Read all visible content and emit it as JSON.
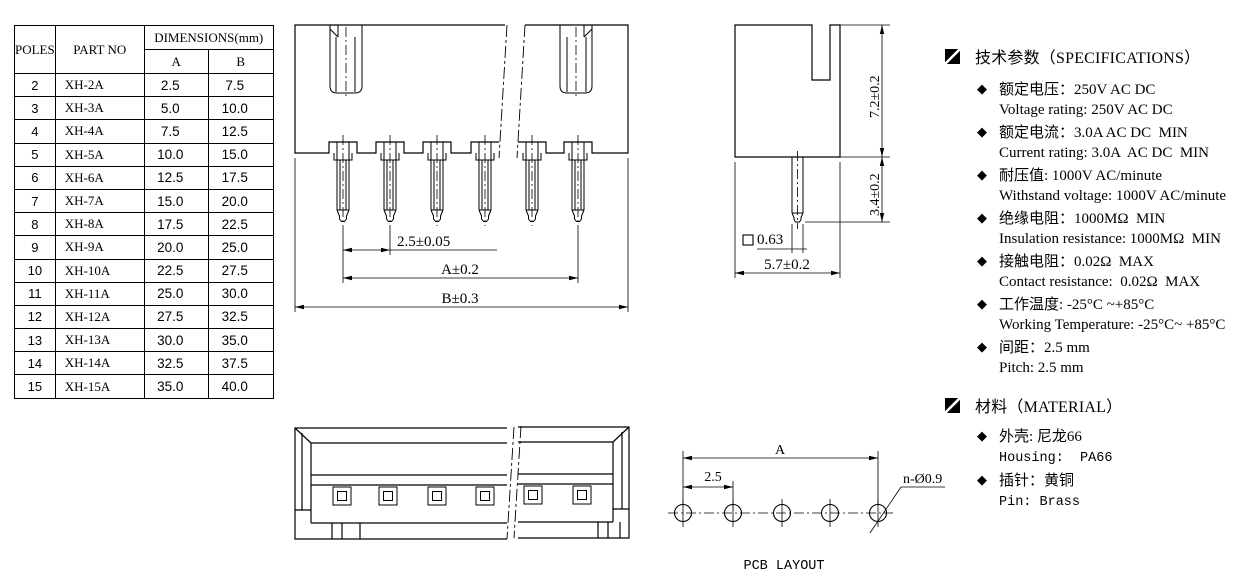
{
  "colors": {
    "line": "#000000",
    "background": "#ffffff"
  },
  "table": {
    "col_poles": "POLES",
    "col_part_no": "PART NO",
    "col_dimensions": "DIMENSIONS(mm)",
    "col_a": "A",
    "col_b": "B",
    "rows": [
      {
        "poles": "2",
        "part": "XH-2A",
        "a": "2.5",
        "b": "7.5"
      },
      {
        "poles": "3",
        "part": "XH-3A",
        "a": "5.0",
        "b": "10.0"
      },
      {
        "poles": "4",
        "part": "XH-4A",
        "a": "7.5",
        "b": "12.5"
      },
      {
        "poles": "5",
        "part": "XH-5A",
        "a": "10.0",
        "b": "15.0"
      },
      {
        "poles": "6",
        "part": "XH-6A",
        "a": "12.5",
        "b": "17.5"
      },
      {
        "poles": "7",
        "part": "XH-7A",
        "a": "15.0",
        "b": "20.0"
      },
      {
        "poles": "8",
        "part": "XH-8A",
        "a": "17.5",
        "b": "22.5"
      },
      {
        "poles": "9",
        "part": "XH-9A",
        "a": "20.0",
        "b": "25.0"
      },
      {
        "poles": "10",
        "part": "XH-10A",
        "a": "22.5",
        "b": "27.5"
      },
      {
        "poles": "11",
        "part": "XH-11A",
        "a": "25.0",
        "b": "30.0"
      },
      {
        "poles": "12",
        "part": "XH-12A",
        "a": "27.5",
        "b": "32.5"
      },
      {
        "poles": "13",
        "part": "XH-13A",
        "a": "30.0",
        "b": "35.0"
      },
      {
        "poles": "14",
        "part": "XH-14A",
        "a": "32.5",
        "b": "37.5"
      },
      {
        "poles": "15",
        "part": "XH-15A",
        "a": "35.0",
        "b": "40.0"
      }
    ]
  },
  "front_view": {
    "dim_pitch": "2.5±0.05",
    "dim_a": "A±0.2",
    "dim_b": "B±0.3"
  },
  "side_view": {
    "dim_height": "7.2±0.2",
    "dim_pin_len": "3.4±0.2",
    "pin_square": "0.63",
    "dim_depth": "5.7±0.2"
  },
  "pcb": {
    "dim_a": "A",
    "dim_pitch": "2.5",
    "hole_label": "n-Ø0.9",
    "caption": "PCB LAYOUT"
  },
  "specs": {
    "title": "技术参数（SPECIFICATIONS）",
    "items": [
      {
        "zh": "额定电压：250V AC DC",
        "en": "Voltage rating: 250V AC DC"
      },
      {
        "zh": "额定电流：3.0A AC DC  MIN",
        "en": "Current rating: 3.0A  AC DC  MIN"
      },
      {
        "zh": "耐压值: 1000V AC/minute",
        "en": "Withstand voltage: 1000V AC/minute"
      },
      {
        "zh": "绝缘电阻：1000MΩ  MIN",
        "en": "Insulation resistance: 1000MΩ  MIN"
      },
      {
        "zh": "接触电阻：0.02Ω  MAX",
        "en": "Contact resistance:  0.02Ω  MAX"
      },
      {
        "zh": "工作温度: -25°C ~+85°C",
        "en": "Working Temperature: -25°C~ +85°C"
      },
      {
        "zh": "间距：2.5 mm",
        "en": "Pitch: 2.5 mm"
      }
    ]
  },
  "material": {
    "title": "材料（MATERIAL）",
    "items": [
      {
        "zh": "外壳: 尼龙66",
        "en": "Housing:  PA66"
      },
      {
        "zh": "插针：黄铜",
        "en": "Pin: Brass"
      }
    ]
  }
}
